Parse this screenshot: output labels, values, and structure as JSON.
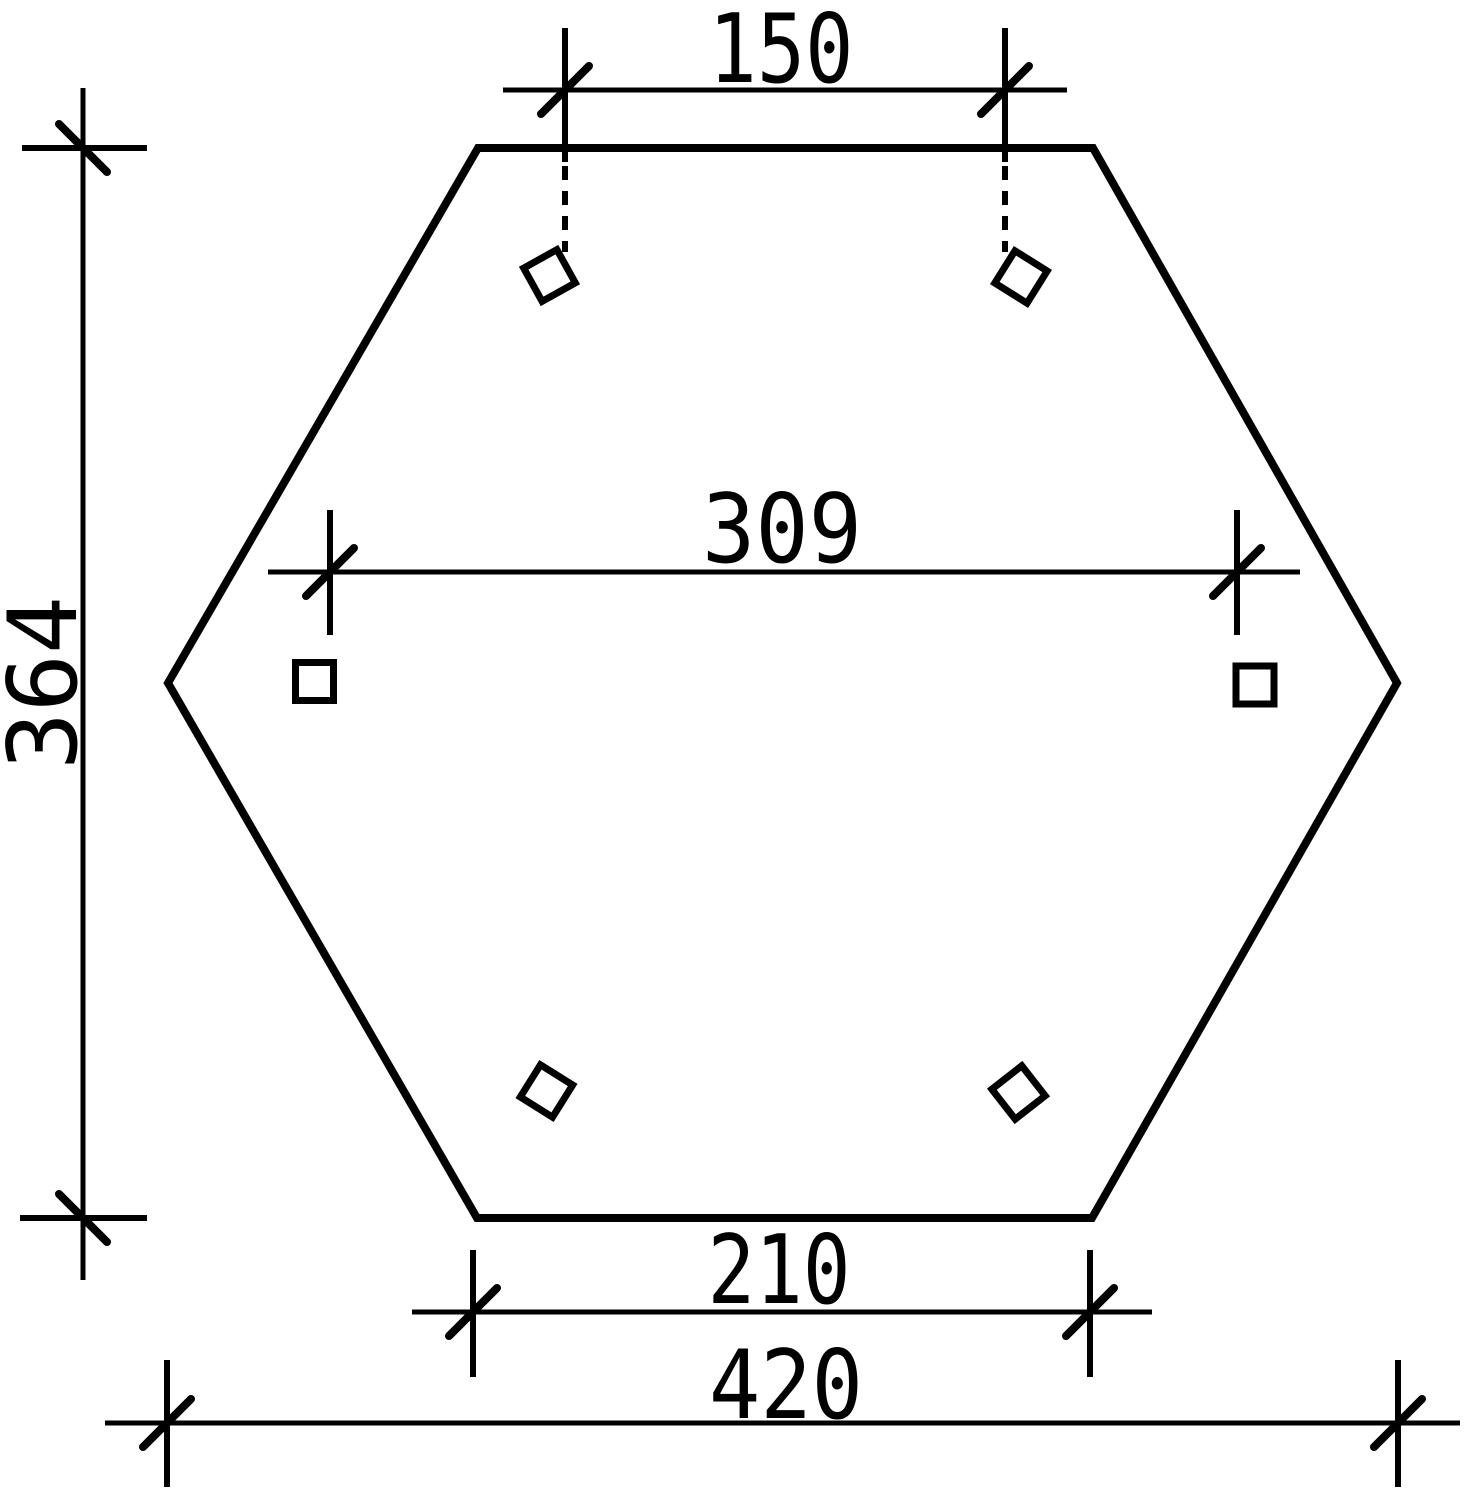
{
  "drawing": {
    "kind": "dimensioned hexagonal floor plan",
    "background_color": "#ffffff",
    "line_color": "#000000",
    "post_markers": {
      "diamond_posts_count": 4,
      "square_posts_count": 2
    },
    "dimensions": {
      "top_post_spacing": {
        "label": "150",
        "value": 150,
        "position": "top",
        "orientation": "horizontal"
      },
      "inner_post_spacing": {
        "label": "309",
        "value": 309,
        "position": "middle",
        "orientation": "horizontal"
      },
      "overall_depth": {
        "label": "364",
        "value": 364,
        "position": "left",
        "orientation": "vertical"
      },
      "bottom_edge_length": {
        "label": "210",
        "value": 210,
        "position": "bottom",
        "orientation": "horizontal"
      },
      "overall_width": {
        "label": "420",
        "value": 420,
        "position": "bottom",
        "orientation": "horizontal"
      }
    }
  }
}
